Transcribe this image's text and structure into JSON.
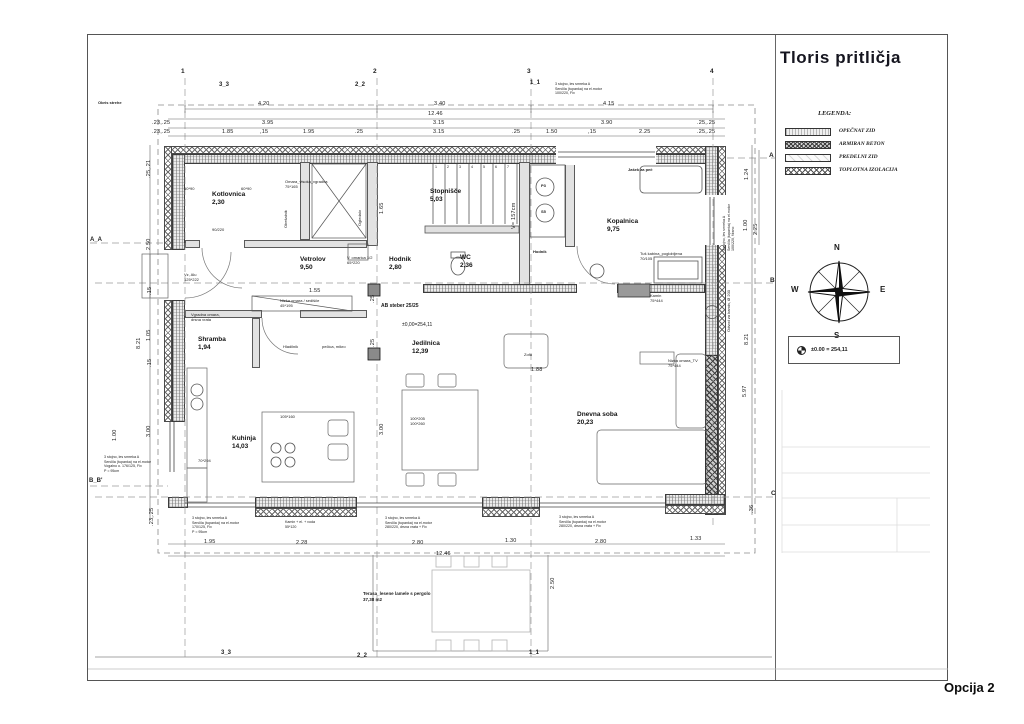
{
  "sheet": {
    "title": "Tloris pritličja",
    "option_label": "Opcija 2"
  },
  "legend": {
    "heading": "LEGENDA:",
    "items": [
      {
        "label": "OPEČNAT ZID",
        "pattern": "brick"
      },
      {
        "label": "ARMIRAN BETON",
        "pattern": "concrete"
      },
      {
        "label": "PREDELNI ZID",
        "pattern": "partition"
      },
      {
        "label": "TOPLOTNA IZOLACIJA",
        "pattern": "insulation"
      }
    ]
  },
  "compass": {
    "n": "N",
    "e": "E",
    "s": "S",
    "w": "W"
  },
  "datum": {
    "text": "±0.00 = 254,11"
  },
  "plan": {
    "grid": {
      "columns": [
        {
          "label": "1",
          "x": 181,
          "y": 68
        },
        {
          "label": "2",
          "x": 373,
          "y": 68
        },
        {
          "label": "3",
          "x": 527,
          "y": 68
        },
        {
          "label": "4",
          "x": 710,
          "y": 68
        }
      ],
      "rows": [
        {
          "label": "A",
          "x": 769,
          "y": 152
        },
        {
          "label": "B",
          "x": 770,
          "y": 277
        },
        {
          "label": "C",
          "x": 771,
          "y": 490
        }
      ]
    },
    "sections": [
      {
        "label": "3_3",
        "x": 219,
        "y": 82
      },
      {
        "label": "2_2",
        "x": 355,
        "y": 82
      },
      {
        "label": "1_1",
        "x": 530,
        "y": 80
      },
      {
        "label": "3_3",
        "x": 221,
        "y": 650
      },
      {
        "label": "2_2",
        "x": 357,
        "y": 653
      },
      {
        "label": "1_1",
        "x": 529,
        "y": 650
      },
      {
        "label": "A_A",
        "x": 90,
        "y": 237
      },
      {
        "label": "B_B'",
        "x": 89,
        "y": 478
      }
    ],
    "stairs": {
      "numbers": [
        "1",
        "2",
        "3",
        "4",
        "5",
        "6",
        "7"
      ],
      "x": 435,
      "y": 165,
      "step": 12
    },
    "rooms": [
      {
        "name": "Kotlovnica",
        "area": "2,30",
        "x": 212,
        "y": 191
      },
      {
        "name": "Stopnišče",
        "area": "5,03",
        "x": 430,
        "y": 188
      },
      {
        "name": "Kopalnica",
        "area": "9,75",
        "x": 607,
        "y": 218
      },
      {
        "name": "Vetrolov",
        "area": "9,50",
        "x": 300,
        "y": 256
      },
      {
        "name": "Hodnik",
        "area": "2,80",
        "x": 389,
        "y": 256
      },
      {
        "name": "WC",
        "area": "2,36",
        "x": 460,
        "y": 254
      },
      {
        "name": "Shramba",
        "area": "1,94",
        "x": 198,
        "y": 336
      },
      {
        "name": "Jedilnica",
        "area": "12,39",
        "x": 412,
        "y": 340
      },
      {
        "name": "Kuhinja",
        "area": "14,03",
        "x": 232,
        "y": 435
      },
      {
        "name": "Dnevna soba",
        "area": "20,23",
        "x": 577,
        "y": 411
      }
    ],
    "dimensions": [
      {
        "t": "4.20",
        "x": 258,
        "y": 101
      },
      {
        "t": "3.40",
        "x": 434,
        "y": 101
      },
      {
        "t": "4.15",
        "x": 603,
        "y": 101
      },
      {
        "t": "12.46",
        "x": 428,
        "y": 111
      },
      {
        "t": ".23,.25",
        "x": 152,
        "y": 120
      },
      {
        "t": "3.95",
        "x": 262,
        "y": 120
      },
      {
        "t": "3.15",
        "x": 433,
        "y": 120
      },
      {
        "t": "3.90",
        "x": 601,
        "y": 120
      },
      {
        "t": ".25,.25",
        "x": 697,
        "y": 120
      },
      {
        "t": ".23,.25",
        "x": 152,
        "y": 129
      },
      {
        "t": "1.85",
        "x": 222,
        "y": 129
      },
      {
        "t": ",15",
        "x": 260,
        "y": 129
      },
      {
        "t": "1.95",
        "x": 303,
        "y": 129
      },
      {
        "t": ".25",
        "x": 355,
        "y": 129
      },
      {
        "t": "3.15",
        "x": 433,
        "y": 129
      },
      {
        "t": ".25",
        "x": 512,
        "y": 129
      },
      {
        "t": "1.50",
        "x": 546,
        "y": 129
      },
      {
        "t": ",15",
        "x": 588,
        "y": 129
      },
      {
        "t": "2.25",
        "x": 639,
        "y": 129
      },
      {
        "t": ".25,.25",
        "x": 697,
        "y": 129
      },
      {
        "t": "1.95",
        "x": 204,
        "y": 539
      },
      {
        "t": "2.28",
        "x": 296,
        "y": 540
      },
      {
        "t": "2.80",
        "x": 412,
        "y": 540
      },
      {
        "t": "1.30",
        "x": 505,
        "y": 538
      },
      {
        "t": "2.80",
        "x": 595,
        "y": 539
      },
      {
        "t": "1.33",
        "x": 690,
        "y": 536
      },
      {
        "t": "12.46",
        "x": 436,
        "y": 551
      },
      {
        "t": ".25,.21",
        "x": 146,
        "y": 178,
        "rot": 1
      },
      {
        "t": "2.50",
        "x": 146,
        "y": 250,
        "rot": 1
      },
      {
        "t": ".15",
        "x": 147,
        "y": 295,
        "rot": 1
      },
      {
        "t": "1.05",
        "x": 146,
        "y": 341,
        "rot": 1
      },
      {
        "t": "8.21",
        "x": 136,
        "y": 349,
        "rot": 1
      },
      {
        "t": ".15",
        "x": 147,
        "y": 367,
        "rot": 1
      },
      {
        "t": "3.00",
        "x": 146,
        "y": 437,
        "rot": 1
      },
      {
        "t": "1.00",
        "x": 112,
        "y": 441,
        "rot": 1
      },
      {
        "t": ".23,.25",
        "x": 149,
        "y": 526,
        "rot": 1
      },
      {
        "t": "1.24",
        "x": 744,
        "y": 180,
        "rot": 1
      },
      {
        "t": "1.00",
        "x": 743,
        "y": 231,
        "rot": 1
      },
      {
        "t": "2.25",
        "x": 753,
        "y": 235,
        "rot": 1
      },
      {
        "t": "8.21",
        "x": 744,
        "y": 345,
        "rot": 1
      },
      {
        "t": "5.97",
        "x": 742,
        "y": 397,
        "rot": 1
      },
      {
        "t": ".36",
        "x": 749,
        "y": 513,
        "rot": 1
      },
      {
        "t": "1.65",
        "x": 379,
        "y": 214,
        "rot": 1
      },
      {
        "t": "V= 157cm",
        "x": 511,
        "y": 229,
        "rot": 1
      },
      {
        "t": "1.55",
        "x": 309,
        "y": 288
      },
      {
        "t": "1.88",
        "x": 531,
        "y": 367
      },
      {
        "t": "3.00",
        "x": 379,
        "y": 435,
        "rot": 1
      },
      {
        "t": "2.50",
        "x": 550,
        "y": 589,
        "rot": 1
      },
      {
        "t": ".25",
        "x": 370,
        "y": 303,
        "rot": 1
      },
      {
        "t": ".25",
        "x": 370,
        "y": 347,
        "rot": 1
      }
    ],
    "labels": [
      {
        "lines": [
          "Obris strehe"
        ],
        "x": 98,
        "y": 100,
        "bold": true
      },
      {
        "lines": [
          "60*90"
        ],
        "x": 184,
        "y": 186
      },
      {
        "lines": [
          "60*90"
        ],
        "x": 241,
        "y": 186
      },
      {
        "lines": [
          "Omara_visoka_vgradna",
          "75*165"
        ],
        "x": 285,
        "y": 179
      },
      {
        "lines": [
          "Obešalnik"
        ],
        "x": 283,
        "y": 228,
        "rot": true
      },
      {
        "lines": [
          "Ogledalo"
        ],
        "x": 357,
        "y": 226,
        "rot": true
      },
      {
        "lines": [
          "90/220"
        ],
        "x": 212,
        "y": 227
      },
      {
        "lines": [
          "Jašek za peč"
        ],
        "x": 628,
        "y": 167,
        "bold": true
      },
      {
        "lines": [
          "Vz, Alu",
          "125*222"
        ],
        "x": 184,
        "y": 272
      },
      {
        "lines": [
          "V. omarica 1/2",
          "65*220"
        ],
        "x": 347,
        "y": 255
      },
      {
        "lines": [
          "Nizka omara / sedišče",
          "45*195"
        ],
        "x": 280,
        "y": 298
      },
      {
        "lines": [
          "Vgradna omara,",
          "drsna vrata"
        ],
        "x": 191,
        "y": 312
      },
      {
        "lines": [
          "Hladilnik"
        ],
        "x": 283,
        "y": 344
      },
      {
        "lines": [
          "pečica, mikro"
        ],
        "x": 322,
        "y": 344
      },
      {
        "lines": [
          "AB steber 25/25"
        ],
        "x": 381,
        "y": 303,
        "bold": true,
        "fs": 5
      },
      {
        "lines": [
          "±0,00=254,11"
        ],
        "x": 402,
        "y": 322,
        "fs": 5
      },
      {
        "lines": [
          "Hodnik"
        ],
        "x": 533,
        "y": 249,
        "bold": true
      },
      {
        "lines": [
          "P3"
        ],
        "x": 541,
        "y": 183,
        "bold": true
      },
      {
        "lines": [
          "S5"
        ],
        "x": 541,
        "y": 209,
        "bold": true
      },
      {
        "lines": [
          "Tuš kabina_poglobljena",
          "70/105"
        ],
        "x": 640,
        "y": 251
      },
      {
        "lines": [
          "Kamin",
          "75*444"
        ],
        "x": 650,
        "y": 293
      },
      {
        "lines": [
          "Nizka omara_TV",
          "75*444"
        ],
        "x": 668,
        "y": 358
      },
      {
        "lines": [
          "Odvod za kamin, Ø 200"
        ],
        "x": 726,
        "y": 332,
        "rot": true
      },
      {
        "lines": [
          "Zofa"
        ],
        "x": 524,
        "y": 352
      },
      {
        "lines": [
          "105*160"
        ],
        "x": 280,
        "y": 414
      },
      {
        "lines": [
          "70*294"
        ],
        "x": 198,
        "y": 458
      },
      {
        "lines": [
          "100*205",
          "100*260"
        ],
        "x": 410,
        "y": 416
      },
      {
        "lines": [
          "3 stojno, les smreka A",
          "Senčila (tupanka) na el.motor",
          "Vogalno o. 176/125, Fix",
          "P = 95cm"
        ],
        "x": 104,
        "y": 455,
        "fs": 3.6
      },
      {
        "lines": [
          "3 stojno, les smreka A",
          "Senčila (tupanka) na el.motor",
          "170/125, Fix",
          "P = 95cm"
        ],
        "x": 192,
        "y": 516,
        "fs": 3.6
      },
      {
        "lines": [
          "Kamin + el. + voda",
          "55*120"
        ],
        "x": 285,
        "y": 520,
        "fs": 3.6
      },
      {
        "lines": [
          "3 stojno, les smreka A",
          "Senčila (tupanka) na el.motor",
          "280/220, drsna vrata + Fix"
        ],
        "x": 385,
        "y": 516,
        "fs": 3.6
      },
      {
        "lines": [
          "3 stojno, les smreka A",
          "Senčila (tupanka) na el.motor",
          "280/220, drsna vrata + Fix"
        ],
        "x": 559,
        "y": 515,
        "fs": 3.6
      },
      {
        "lines": [
          "3 stojno, les smreka A",
          "Senčila (tupanka) na el.motor",
          "100/220, Fix"
        ],
        "x": 555,
        "y": 82,
        "fs": 3.6
      },
      {
        "lines": [
          "3 stojno, les smreka A",
          "Senčila (tupanka) na el.motor",
          "100/220, fiksno"
        ],
        "x": 722,
        "y": 251,
        "fs": 3.6,
        "rot": true
      },
      {
        "lines": [
          "Terasa_lesene lamele s pergolo",
          "37,38 m2"
        ],
        "x": 363,
        "y": 591,
        "fs": 4.5,
        "bold": true
      }
    ]
  }
}
